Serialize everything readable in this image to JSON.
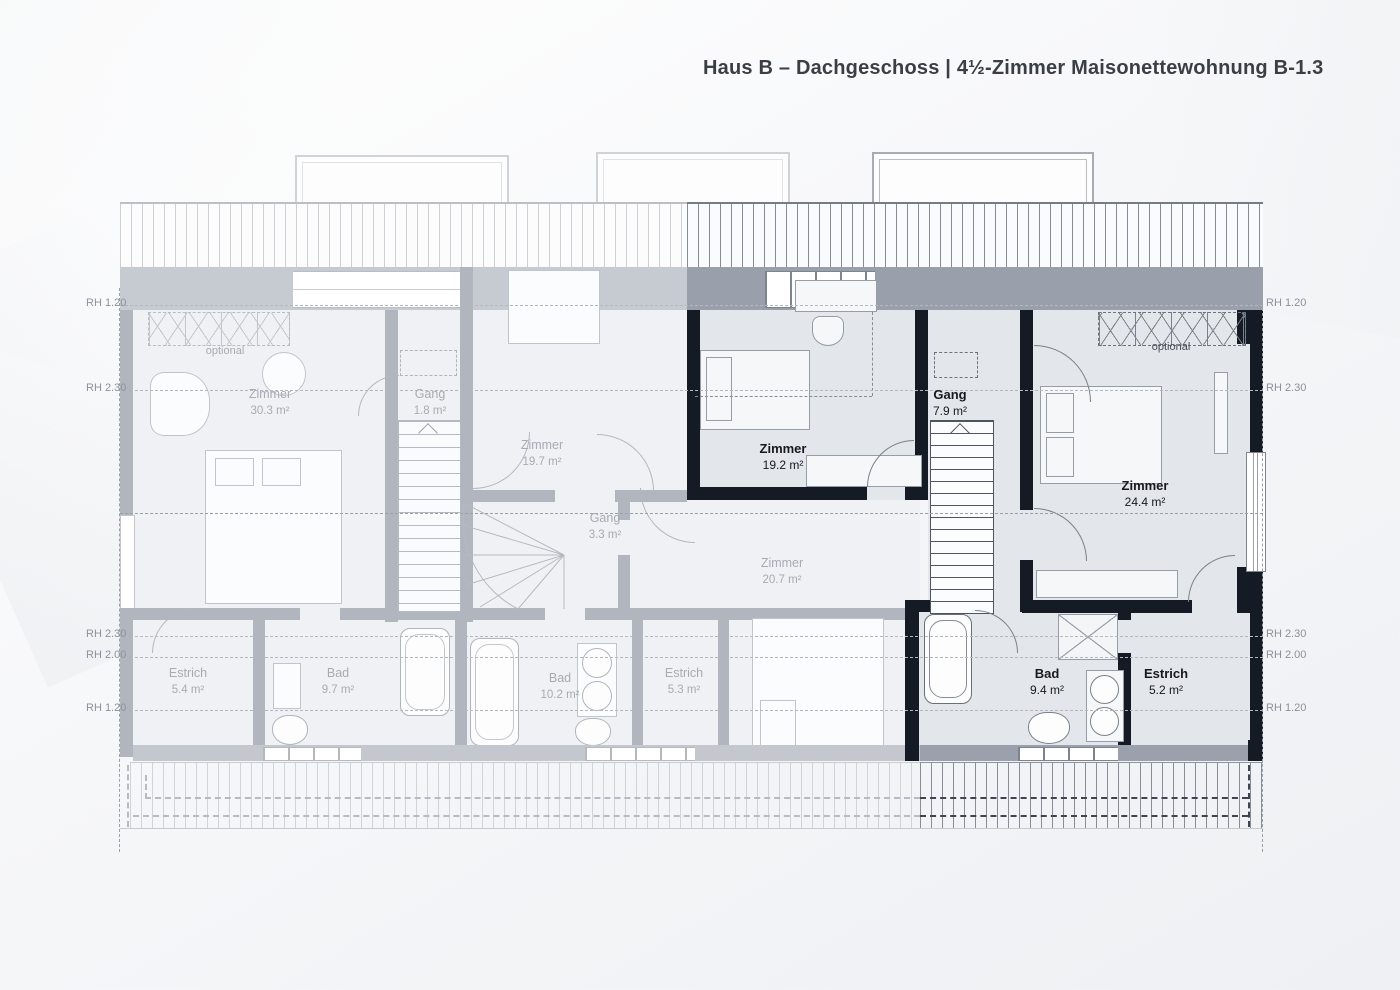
{
  "title": "Haus B – Dachgeschoss | 4½-Zimmer Maisonettewohnung B-1.3",
  "plan": {
    "faded_rooms": [
      {
        "name": "Zimmer",
        "area": "30.3 m²"
      },
      {
        "name": "Gang",
        "area": "1.8 m²"
      },
      {
        "name": "Zimmer",
        "area": "19.7 m²"
      },
      {
        "name": "Gang",
        "area": "3.3 m²"
      },
      {
        "name": "Zimmer",
        "area": "20.7 m²"
      },
      {
        "name": "Estrich",
        "area": "5.4 m²"
      },
      {
        "name": "Bad",
        "area": "9.7 m²"
      },
      {
        "name": "Bad",
        "area": "10.2 m²"
      },
      {
        "name": "Estrich",
        "area": "5.3 m²"
      }
    ],
    "highlight_rooms": [
      {
        "name": "Zimmer",
        "area": "19.2 m²"
      },
      {
        "name": "Gang",
        "area": "7.9 m²"
      },
      {
        "name": "Zimmer",
        "area": "24.4 m²"
      },
      {
        "name": "Bad",
        "area": "9.4 m²"
      },
      {
        "name": "Estrich",
        "area": "5.2 m²"
      }
    ],
    "optional_left": "optional",
    "optional_right": "optional",
    "height_labels_left": [
      "RH 1.20",
      "RH 2.30",
      "RH 2.30",
      "RH 2.00",
      "RH 1.20"
    ],
    "height_labels_right": [
      "RH 1.20",
      "RH 2.30",
      "RH 2.30",
      "RH 2.00",
      "RH 1.20"
    ],
    "colors": {
      "highlight_wall": "#151b25",
      "faded_wall": "#b0b5be",
      "band_grey": "#99a0ab",
      "room_fill": "#e3e6ea",
      "title_text": "#3b3f45"
    }
  }
}
